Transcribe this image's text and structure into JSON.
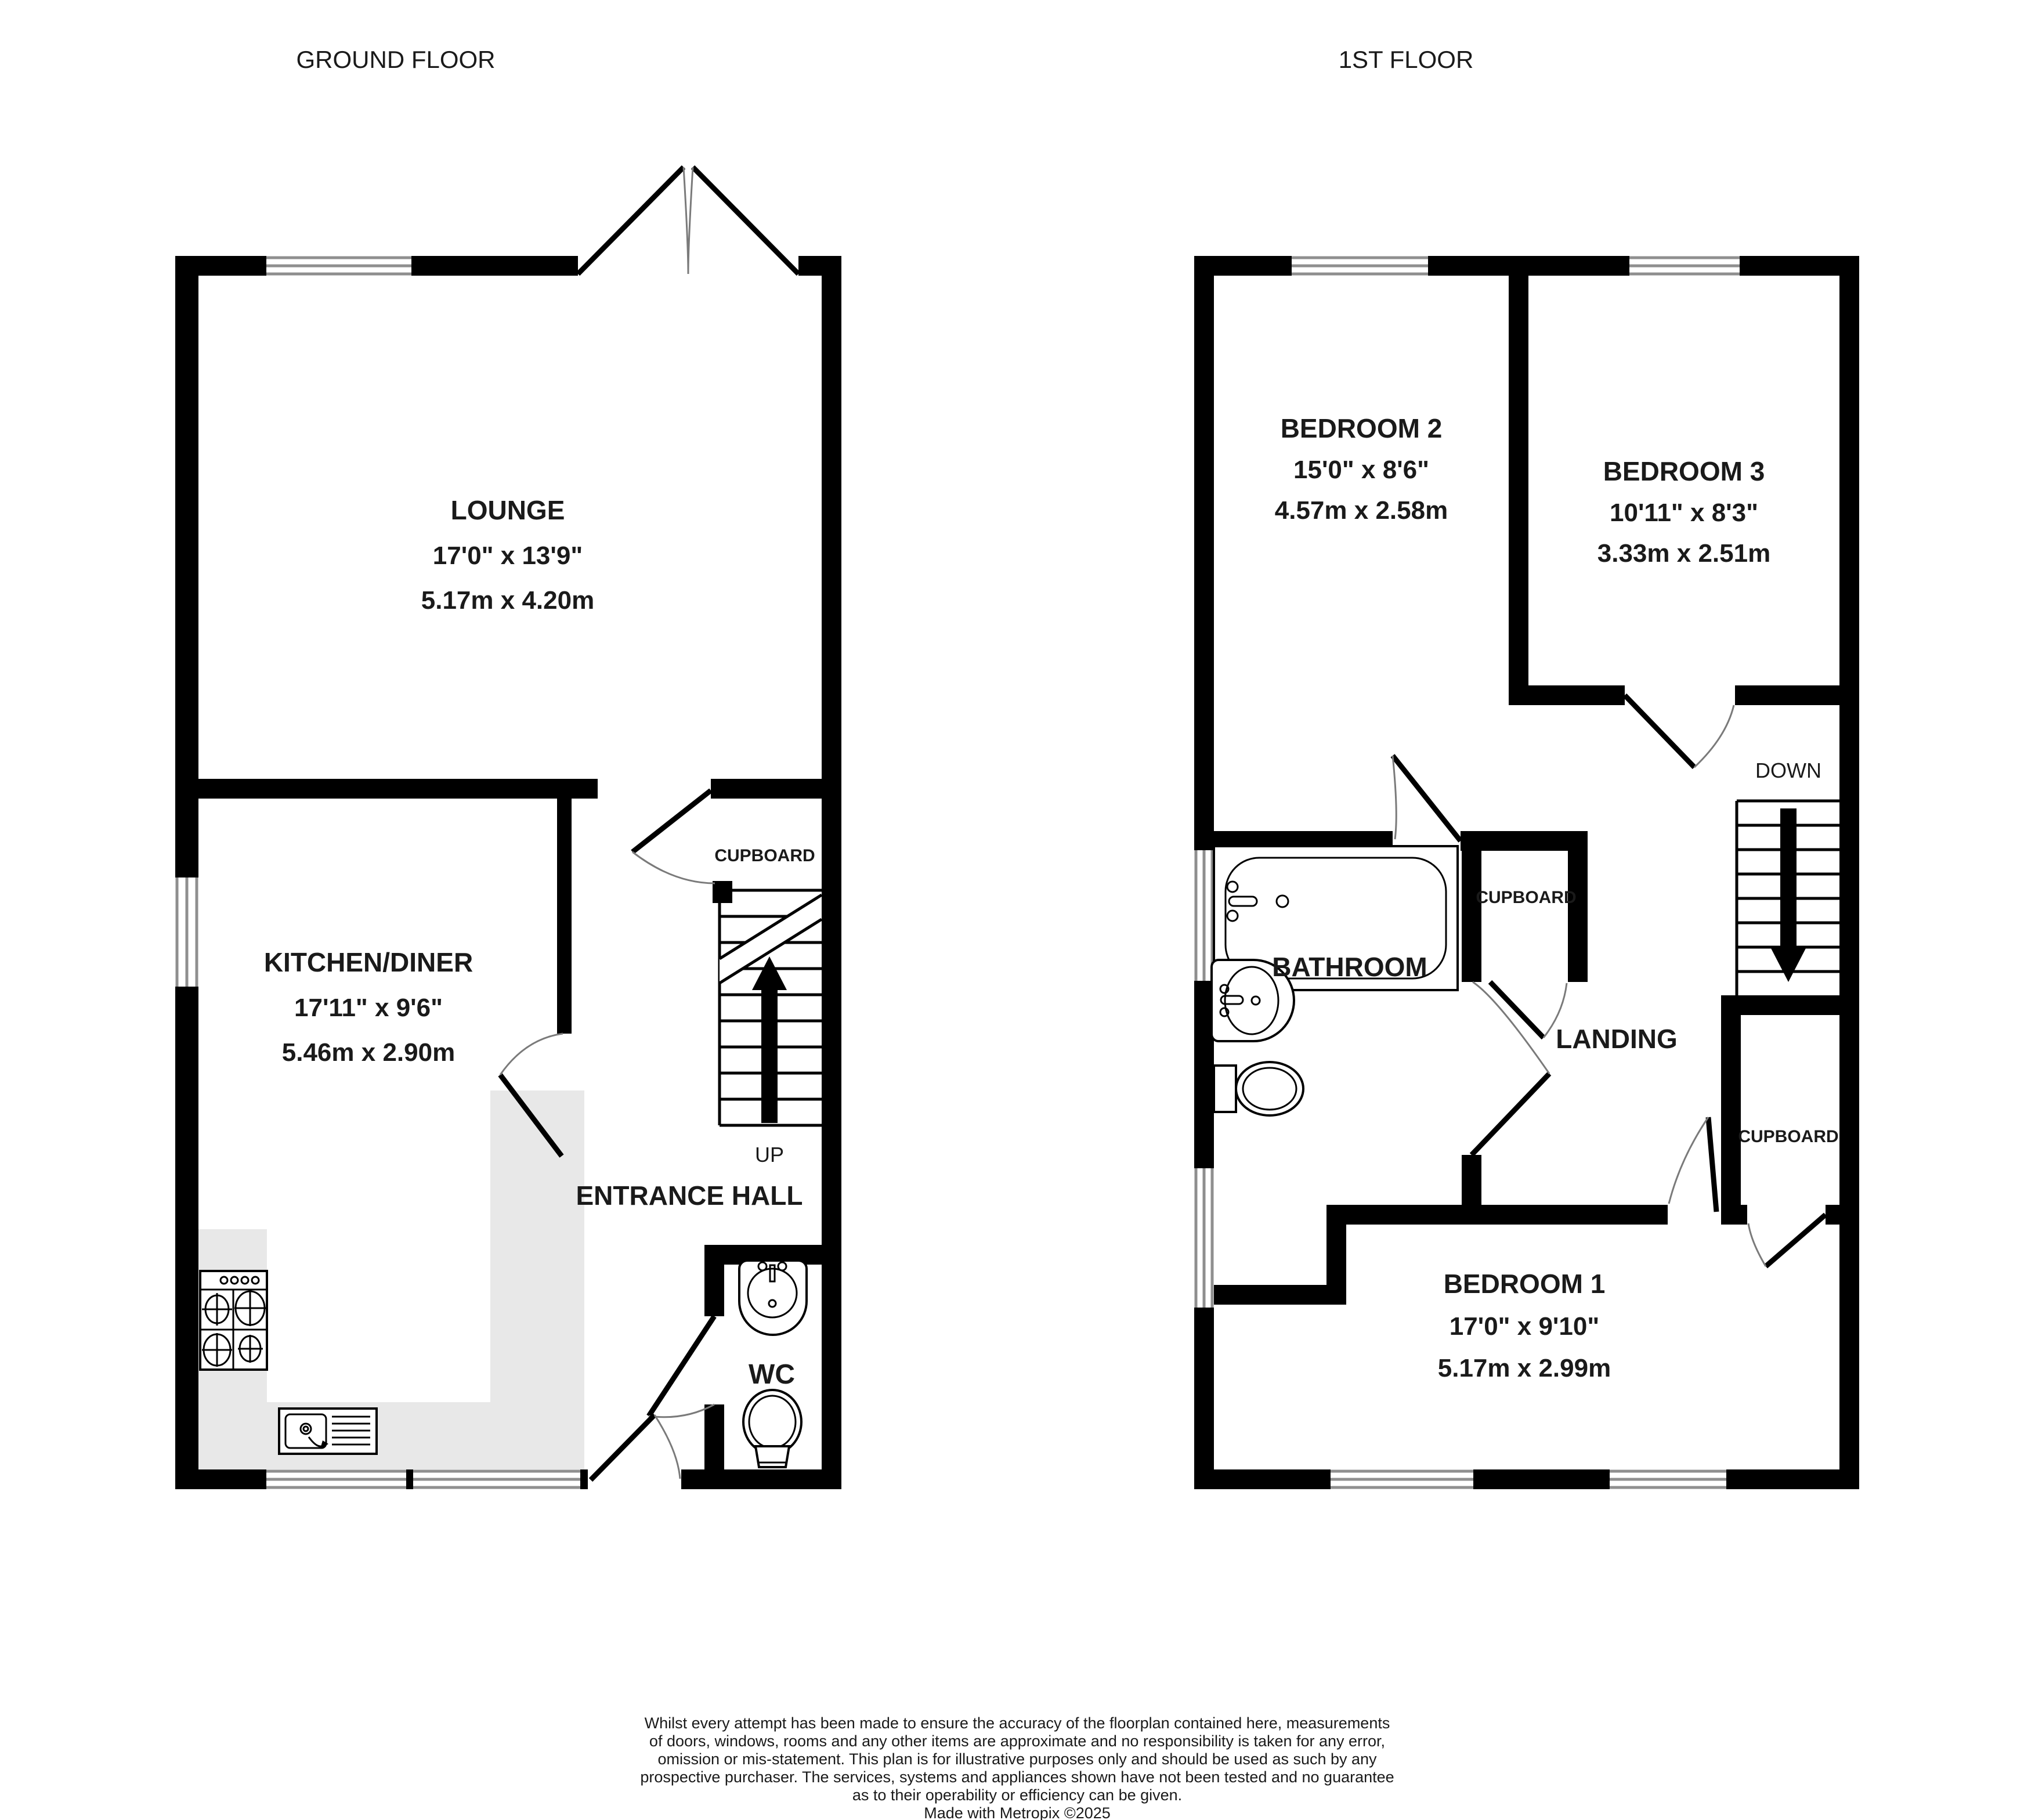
{
  "floors": {
    "ground": {
      "title": "GROUND FLOOR",
      "stairs_label": "UP",
      "rooms": {
        "lounge": {
          "name": "LOUNGE",
          "imperial": "17'0\"  x 13'9\"",
          "metric": "5.17m  x 4.20m"
        },
        "kitchen": {
          "name": "KITCHEN/DINER",
          "imperial": "17'11\"  x 9'6\"",
          "metric": "5.46m  x 2.90m"
        },
        "cupboard": {
          "name": "CUPBOARD"
        },
        "entrance_hall": {
          "name": "ENTRANCE HALL"
        },
        "wc": {
          "name": "WC"
        }
      }
    },
    "first": {
      "title": "1ST FLOOR",
      "stairs_label": "DOWN",
      "rooms": {
        "bedroom2": {
          "name": "BEDROOM 2",
          "imperial": "15'0\"  x 8'6\"",
          "metric": "4.57m  x 2.58m"
        },
        "bedroom3": {
          "name": "BEDROOM 3",
          "imperial": "10'11\"  x 8'3\"",
          "metric": "3.33m  x 2.51m"
        },
        "bedroom1": {
          "name": "BEDROOM 1",
          "imperial": "17'0\"  x 9'10\"",
          "metric": "5.17m  x 2.99m"
        },
        "bathroom": {
          "name": "BATHROOM"
        },
        "landing": {
          "name": "LANDING"
        },
        "cupboard_mid": {
          "name": "CUPBOARD"
        },
        "cupboard_br": {
          "name": "CUPBOARD"
        }
      }
    }
  },
  "disclaimer": {
    "lines": [
      "Whilst every attempt has been made to ensure the accuracy of the floorplan contained here, measurements",
      "of doors, windows, rooms and any other items are approximate and no responsibility is taken for any error,",
      "omission or mis-statement. This plan is for illustrative purposes only and should be used as such by any",
      "prospective purchaser. The services, systems and appliances shown have not been tested and no guarantee",
      "as to their operability or efficiency can be given.",
      "Made with Metropix ©2025"
    ]
  },
  "icons": {
    "stairs_up": "stairs-up-arrow-icon",
    "stairs_down": "stairs-down-arrow-icon",
    "bath": "bathtub-icon",
    "basin": "wash-basin-icon",
    "toilet": "toilet-icon",
    "stove": "stove-hob-icon",
    "sink": "kitchen-sink-icon",
    "double_doors": "french-doors-icon"
  },
  "colors": {
    "wall": "#000000",
    "counter": "#e8e8e8",
    "window_line": "#8f8f8f",
    "door_arc": "#7a7a7a",
    "text": "#1a1a1a",
    "background": "#ffffff"
  }
}
